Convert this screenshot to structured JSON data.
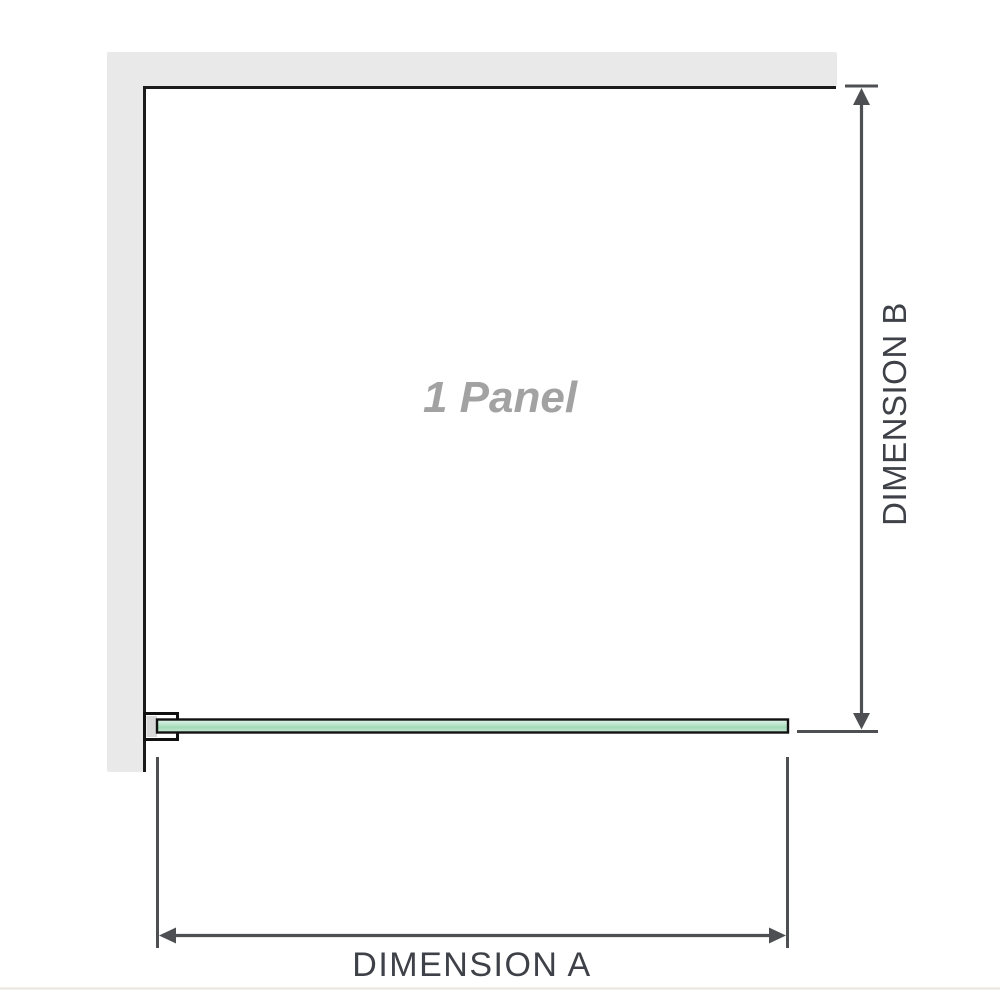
{
  "labels": {
    "panel": "1 Panel",
    "dimension_a": "DIMENSION A",
    "dimension_b": "DIMENSION B"
  },
  "colors": {
    "background": "#ffffff",
    "wall_fill": "#e9e9e9",
    "frame_line": "#1b1b1b",
    "glass_outline": "#111111",
    "glass_light": "#e2f3e9",
    "glass_mid": "#bfe7cf",
    "glass_deep": "#a3dab8",
    "glass_bottom": "#c6e9d3",
    "bracket_fill": "#ffffff",
    "bracket_inner": "#d8d8d8",
    "dimension_line": "#4d4f52",
    "dimension_text": "#3e4147",
    "panel_text": "#a2a2a2",
    "footer_rule": "#e8e5df"
  }
}
